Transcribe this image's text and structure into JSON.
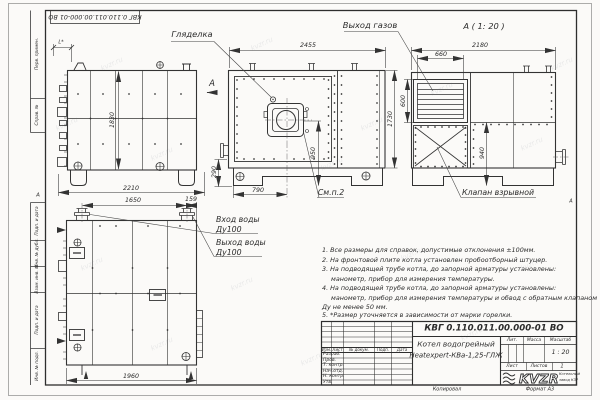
{
  "sheet": {
    "doc_number_top": "КВГ 0.110.011.00.000-01 ВО",
    "watermark": "kvzr.ru",
    "zone_marker_left": "А",
    "zone_marker_right": "А",
    "copied_label": "Копировал",
    "format_label": "Формат А3"
  },
  "frame_fields": {
    "top": [
      "Перв. примен.",
      "Справ. №"
    ],
    "bottom": [
      "Подп. и дата",
      "Инв. № дубл.",
      "Взам. инв. №",
      "Подп. и дата",
      "Инв. № подл."
    ]
  },
  "callouts": {
    "peephole": "Гляделка",
    "gas_outlet": "Выход газов",
    "view_a_title": "А ( 1: 20 )",
    "view_arrow": "А",
    "see_note": "См.п.2",
    "explosion_valve": "Клапан взрывной",
    "water_inlet": "Вход воды",
    "water_inlet_dn": "Ду100",
    "water_outlet": "Выход воды",
    "water_outlet_dn": "Ду100"
  },
  "dimensions": {
    "side_height": "1830",
    "side_width": "2210",
    "side_asterisk": "L*",
    "front_width": "2455",
    "front_height": "1730",
    "burner_axis_height": "950",
    "base_height": "290",
    "burner_offset": "790",
    "viewa_width": "2180",
    "louver_width": "660",
    "louver_height": "600",
    "lower_panel_height": "940",
    "nozzle_spacing": "1650",
    "nozzle_edge_offset": "159",
    "rear_width": "1960"
  },
  "notes": {
    "lines": [
      "1. Все размеры для справок, допустимые отклонения ±100мм.",
      "2. На фронтовой плите котла установлен пробоотборный штуцер.",
      "3. На подводящей трубе котла, до запорной арматуры установлены:",
      "манометр, прибор для измерения температуры.",
      "4. На подводящей трубе котла, до запорной арматуры установлены:",
      "манометр, прибор для измерения температуры и обвод с обратным клапаном",
      "Ду не менее 50 мм.",
      "5. *Размер уточняется в зависимости от марки горелки."
    ]
  },
  "title_block": {
    "doc_number": "КВГ 0.110.011.00.000-01 ВО",
    "product_name_line1": "Котел водогрейный",
    "product_name_line2": "Heatexpert-КВа-1,25-ГЛЖ",
    "header_cols": [
      "Изм.",
      "Лист",
      "№ докум.",
      "Подп.",
      "Дата"
    ],
    "rows": [
      "Разраб.",
      "Пров.",
      "Т. контр.",
      "Нач.отд.",
      "Н. контр.",
      "Утв."
    ],
    "lit_label": "Лит.",
    "mass_label": "Масса",
    "scale_label": "Масштаб",
    "scale_value": "1 : 20",
    "sheet_label": "Лист",
    "sheets_label": "Листов",
    "sheets_value": "1",
    "logo_text": "KVZR",
    "logo_sub_line1": "Котельный",
    "logo_sub_line2": "завод КЗР"
  }
}
